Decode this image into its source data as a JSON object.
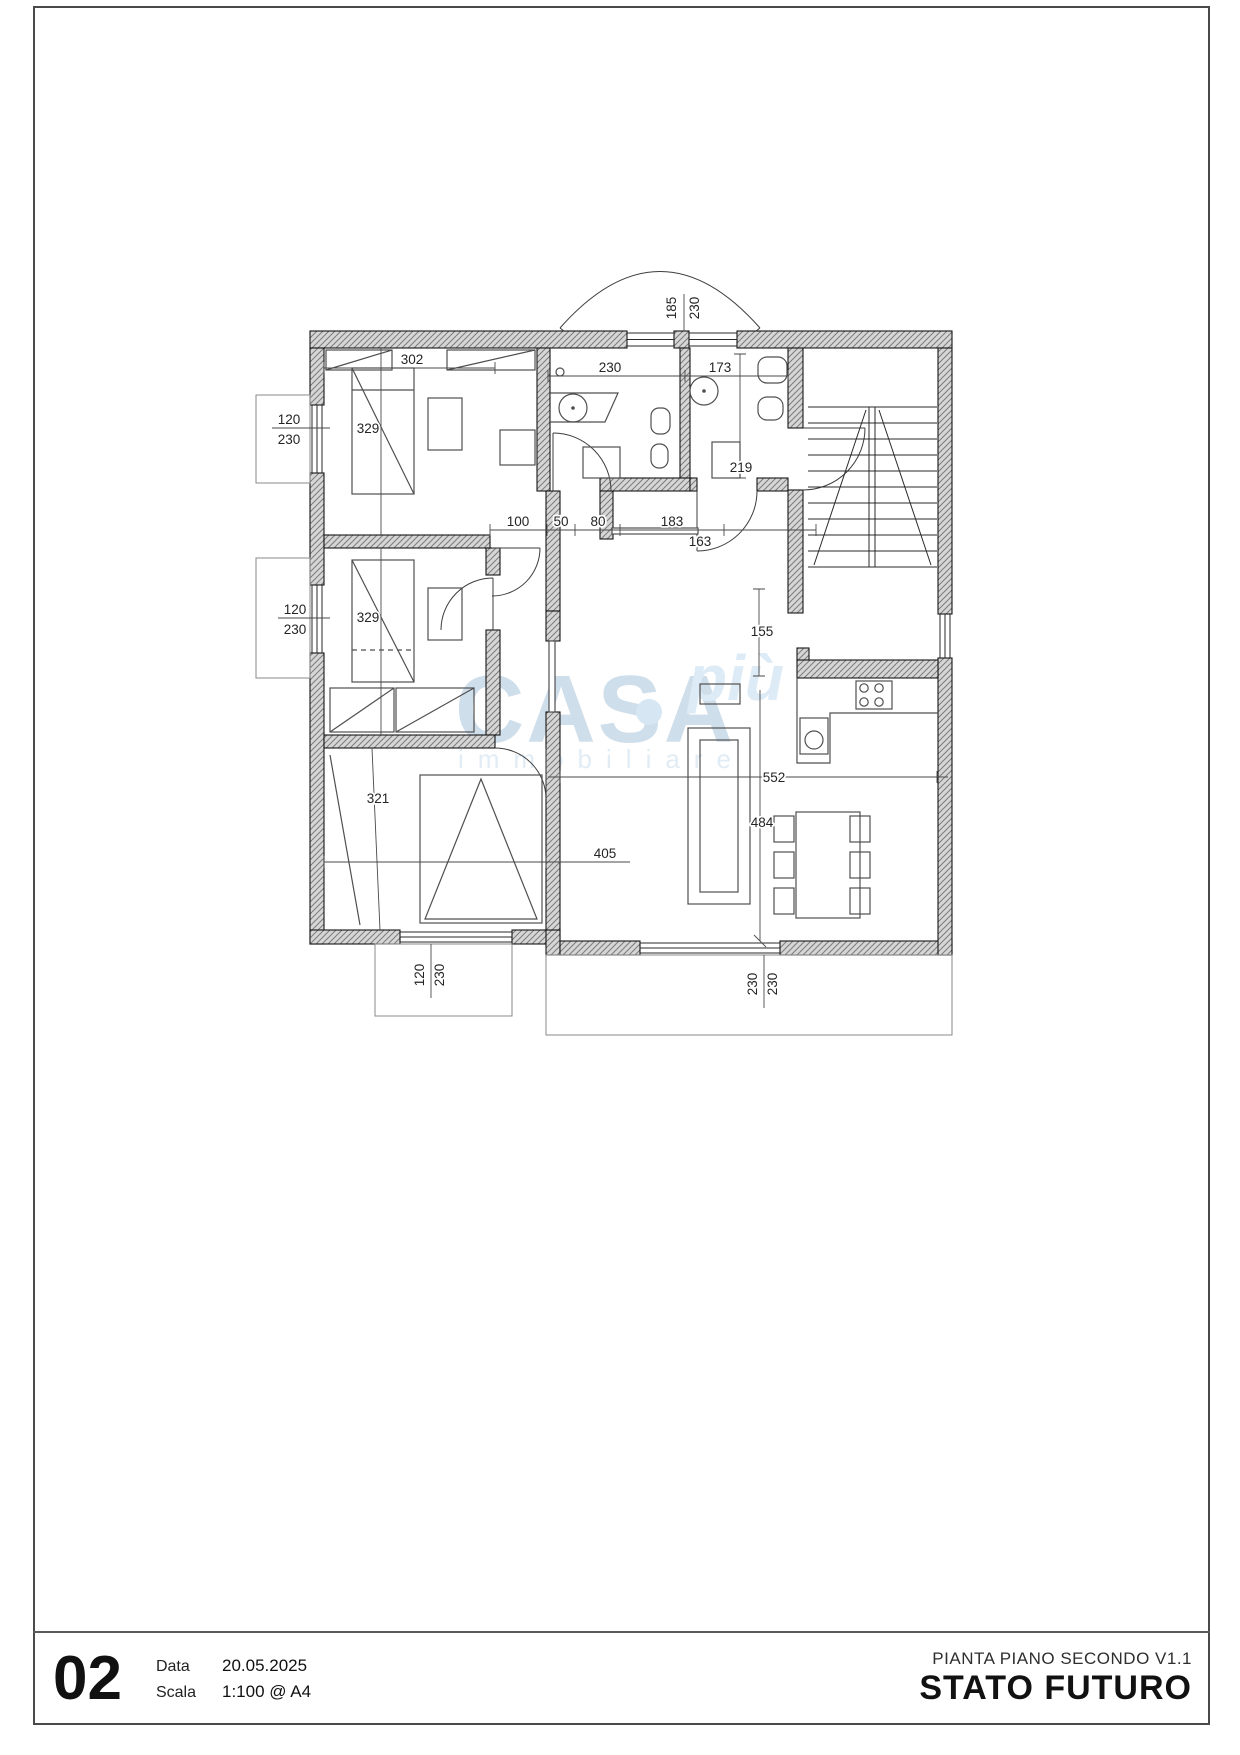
{
  "watermark": {
    "line1": "CASA",
    "accent": "più",
    "line2": "immobiliare",
    "color": "#c7d9e8",
    "accent_color": "#d8e8f5"
  },
  "title_block": {
    "sheet_number": "02",
    "date_label": "Data",
    "date_value": "20.05.2025",
    "scale_label": "Scala",
    "scale_value": "1:100 @ A4",
    "drawing_title": "PIANTA PIANO SECONDO V1.1",
    "status": "STATO FUTURO"
  },
  "dims": {
    "top_window_w": "185",
    "top_window_h": "230",
    "left_win1_w": "120",
    "left_win1_h": "230",
    "left_win2_w": "120",
    "left_win2_h": "230",
    "bottom_win_w": "120",
    "bottom_win_h": "230",
    "terrace_win_w": "230",
    "terrace_win_h": "230",
    "bed1_w": "302",
    "bed1_h": "329",
    "bed2_h": "329",
    "bed3_w": "405",
    "bed3_h": "321",
    "bath_w": "230",
    "wc_w": "173",
    "wc_h": "219",
    "hall_a": "100",
    "hall_b": "50",
    "hall_c": "80",
    "hall_d": "183",
    "hall_e": "163",
    "landing_h": "155",
    "living_w": "552",
    "living_h": "484"
  }
}
